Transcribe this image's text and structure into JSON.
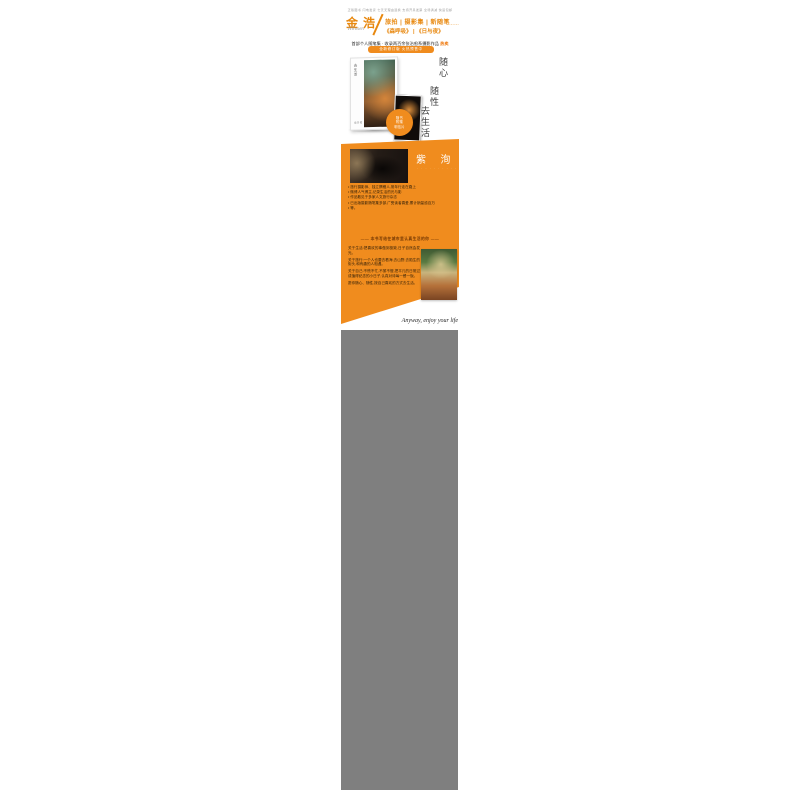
{
  "page": {
    "accent_orange": "#f08c1e",
    "heading_orange": "#e8880f",
    "placeholder_gray": "#7f7f7f",
    "background": "#ffffff"
  },
  "header": {
    "microcopy": "正版图书 闪电发货 七天无理由退换 支持开具发票 全场满减 快递包邮",
    "title_left": "金浩",
    "title_tags": "旅拍 | 摄影集 | 新随笔",
    "title_ellipsis": "……",
    "script_name": "Hirosen",
    "title_works": "《森呼吸》 | 《日与夜》",
    "subtitle_black": "首部个人随笔集 · 收录两百余张治愈系摄影作品 ",
    "subtitle_highlight": "热卖",
    "pill_label": "全新修订版 火热预售中"
  },
  "hero": {
    "vertical_text": [
      "随心",
      "随性",
      "去生活"
    ],
    "badge_lines": [
      "随书",
      "附赠",
      "明信片"
    ],
    "book_title_vertical": "去生活",
    "book_caption": "金浩 著",
    "photo_card_name": "polaroid-photo",
    "cover_photo_name": "book-cover-photo"
  },
  "author": {
    "name": "紫 洵",
    "subtitle_dots": "· · · · · · · · · ·",
    "bullets": [
      "旅行摄影师、独立撰稿人,常年行走在路上",
      "微博人气博主,记录生活的光与影",
      "作品散见于多家人文旅行杂志",
      "已出版摄影随笔集多部,广受读者喜爱,累计销量逾百万",
      "等。"
    ],
    "divider_quote": "—— 本书写给在城市里认真生活的你 ——",
    "paragraphs": [
      "关于生活:把喜欢的事做到极致,日子自然会发光。",
      "关于旅行:一个人也要去看海,去山野,去陌生的街头,和有趣的人相遇。",
      "关于自己:不慌不忙,不紧不慢,把平凡的日常过成值得纪念的小日子,认真对待每一餐一饭。",
      "愿你随心、随性,按自己喜欢的方式去生活。"
    ]
  },
  "signature": "Anyway, enjoy your life"
}
